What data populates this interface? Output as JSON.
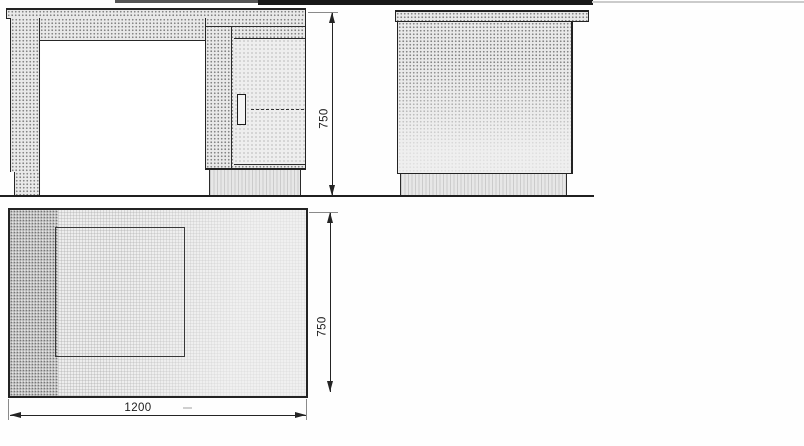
{
  "drawing": {
    "front_view": {
      "height_dim": "750"
    },
    "plan_view": {
      "width_dim": "1200",
      "depth_dim": "750"
    }
  },
  "colors": {
    "line": "#242424",
    "panel_fill": "#e9e9e9",
    "texture_dot": "#8f8f8f",
    "dim_text": "#1b1b1b",
    "background": "#ffffff"
  }
}
